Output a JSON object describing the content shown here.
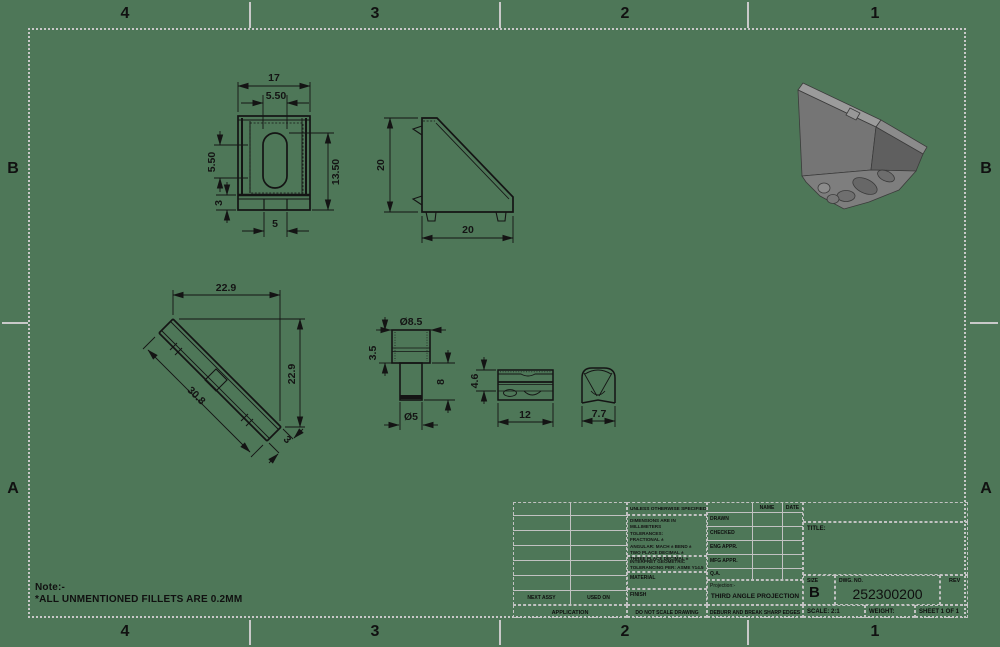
{
  "sheet": {
    "bg_color": "#4e7758",
    "frame_color": "#c9c9c9",
    "ink_color": "#141414"
  },
  "zones": {
    "top": [
      "4",
      "3",
      "2",
      "1"
    ],
    "bottom": [
      "4",
      "3",
      "2",
      "1"
    ],
    "left": [
      "B",
      "A"
    ],
    "right": [
      "B",
      "A"
    ]
  },
  "note": {
    "line1": "Note:-",
    "line2": "*ALL UNMENTIONED FILLETS ARE 0.2MM"
  },
  "views": {
    "front": {
      "dims": {
        "width": "17",
        "slot_width": "5.50",
        "slot_height": "5.50",
        "height": "13.50",
        "base": "3",
        "tab": "5"
      }
    },
    "side": {
      "dims": {
        "height": "20",
        "width": "20"
      }
    },
    "plan": {
      "dims": {
        "width": "22.9",
        "height": "22.9",
        "diagonal": "30.8",
        "thickness": "3"
      }
    },
    "pin": {
      "dims": {
        "head_dia": "Ø8.5",
        "head_height": "3.5",
        "length": "8",
        "shaft_dia": "Ø5"
      }
    },
    "block": {
      "dims": {
        "height": "4.6",
        "width": "12"
      }
    },
    "clip": {
      "dims": {
        "width": "7.7"
      }
    }
  },
  "title_block": {
    "tolerance_header": "UNLESS OTHERWISE SPECIFIED:",
    "tolerance_lines": [
      "DIMENSIONS ARE IN MILLIMETERS",
      "TOLERANCES:",
      "FRACTIONAL ±",
      "ANGULAR: MACH ±   BEND ±",
      "TWO PLACE DECIMAL    ±",
      "THREE PLACE DECIMAL  ±"
    ],
    "interpret_line1": "INTERPRET GEOMETRIC",
    "interpret_line2": "TOLERANCING PER:",
    "interpret_value": "ASME Y14.5",
    "material_label": "MATERIAL",
    "finish_label": "FINISH",
    "do_not_scale": "DO NOT SCALE DRAWING",
    "name_col": "NAME",
    "date_col": "DATE",
    "approval_rows": [
      "DRAWN",
      "CHECKED",
      "ENG APPR.",
      "MFG APPR.",
      "Q.A."
    ],
    "projection_label": "Projection:-",
    "projection_value": "THIRD ANGLE PROJECTION",
    "deburr": "DEBURR AND BREAK SHARP EDGES",
    "next_assy": "NEXT ASSY",
    "used_on": "USED ON",
    "application": "APPLICATION",
    "title_label": "TITLE:",
    "size_label": "SIZE",
    "size_value": "B",
    "dwg_label": "DWG.  NO.",
    "dwg_value": "252300200",
    "rev_label": "REV",
    "scale": "SCALE: 2:1",
    "weight": "WEIGHT:",
    "sheet": "SHEET 1 OF 1"
  }
}
